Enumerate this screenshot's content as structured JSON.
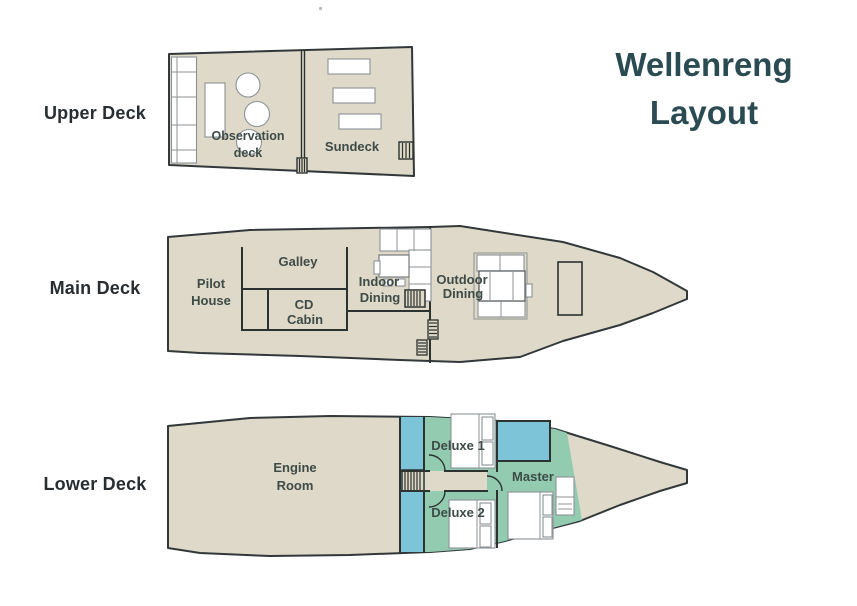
{
  "title": {
    "line1": "Wellenreng",
    "line2": "Layout"
  },
  "deck_labels": {
    "upper": "Upper Deck",
    "main": "Main Deck",
    "lower": "Lower Deck"
  },
  "upper_deck": {
    "observation_line1": "Observation",
    "observation_line2": "deck",
    "sundeck": "Sundeck"
  },
  "main_deck": {
    "pilot_line1": "Pilot",
    "pilot_line2": "House",
    "galley": "Galley",
    "cd_line1": "CD",
    "cd_line2": "Cabin",
    "indoor_line1": "Indoor",
    "indoor_line2": "Dining",
    "outdoor_line1": "Outdoor",
    "outdoor_line2": "Dining"
  },
  "lower_deck": {
    "engine_line1": "Engine",
    "engine_line2": "Room",
    "deluxe1": "Deluxe 1",
    "deluxe2": "Deluxe 2",
    "master": "Master"
  },
  "colors": {
    "deck_fill": "#ded9c8",
    "hull_border": "#32383a",
    "wall": "#2c322f",
    "cabin_blue": "#7dc4d9",
    "cabin_green": "#92cbb0",
    "furniture_white": "#ffffff",
    "furniture_stroke": "#8d9296",
    "title_text": "#2b4b52",
    "deck_label_text": "#272d31",
    "room_label_text": "#3e4b47"
  }
}
